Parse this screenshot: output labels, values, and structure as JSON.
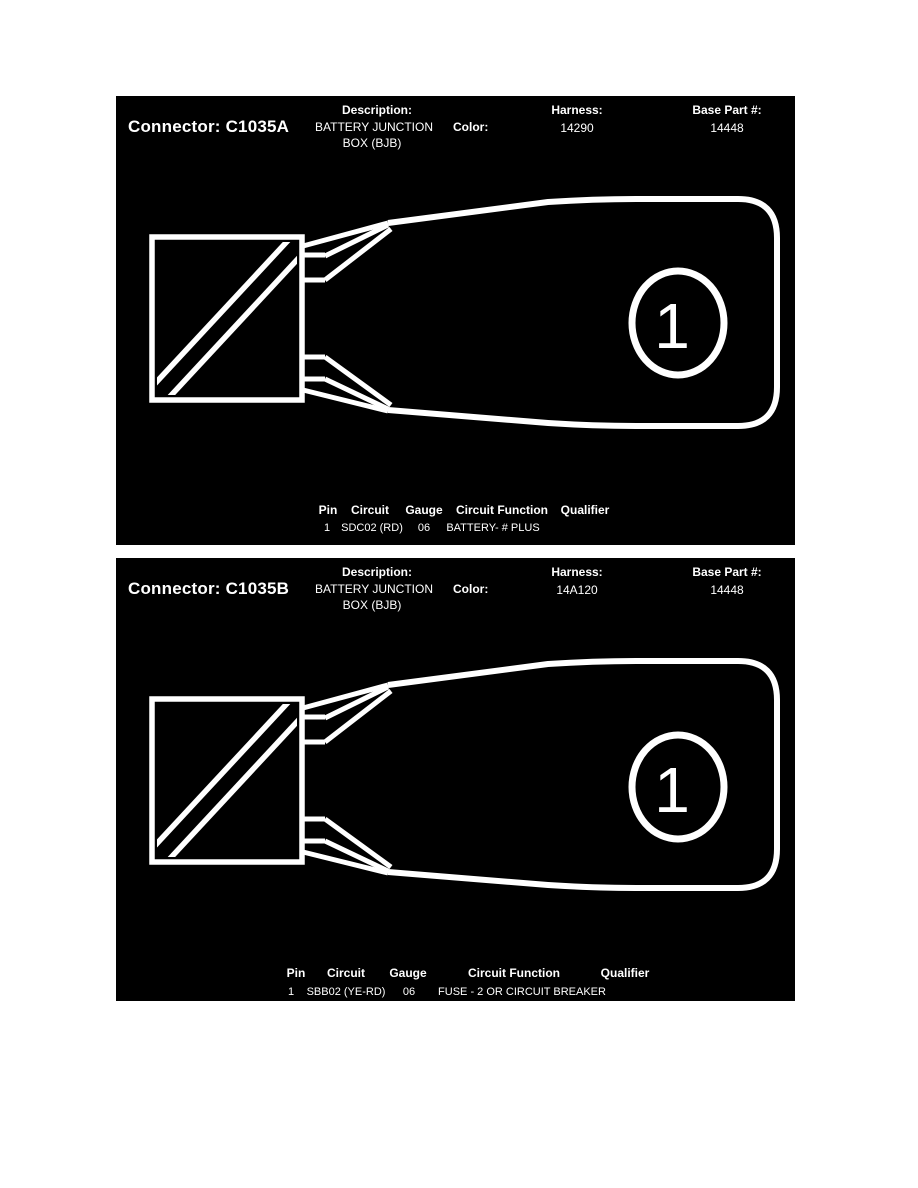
{
  "colors": {
    "page_background": "#ffffff",
    "panel_background": "#000000",
    "foreground": "#ffffff"
  },
  "panels": [
    {
      "connector_label": "Connector: C1035A",
      "description_label": "Description:",
      "description_line1": "BATTERY JUNCTION",
      "description_line2": "BOX (BJB)",
      "color_label": "Color:",
      "color_value": "",
      "harness_label": "Harness:",
      "harness_value": "14290",
      "base_part_label": "Base Part #:",
      "base_part_value": "14448",
      "terminal_callout": "1",
      "table": {
        "headers": [
          "Pin",
          "Circuit",
          "Gauge",
          "Circuit Function",
          "Qualifier"
        ],
        "rows": [
          {
            "pin": "1",
            "circuit": "SDC02 (RD)",
            "gauge": "06",
            "circuit_function": "BATTERY- # PLUS",
            "qualifier": ""
          }
        ]
      }
    },
    {
      "connector_label": "Connector: C1035B",
      "description_label": "Description:",
      "description_line1": "BATTERY JUNCTION",
      "description_line2": "BOX (BJB)",
      "color_label": "Color:",
      "color_value": "",
      "harness_label": "Harness:",
      "harness_value": "14A120",
      "base_part_label": "Base Part #:",
      "base_part_value": "14448",
      "terminal_callout": "1",
      "table": {
        "headers": [
          "Pin",
          "Circuit",
          "Gauge",
          "Circuit Function",
          "Qualifier"
        ],
        "rows": [
          {
            "pin": "1",
            "circuit": "SBB02 (YE-RD)",
            "gauge": "06",
            "circuit_function": "FUSE - 2 OR CIRCUIT BREAKER",
            "qualifier": ""
          }
        ]
      }
    }
  ]
}
